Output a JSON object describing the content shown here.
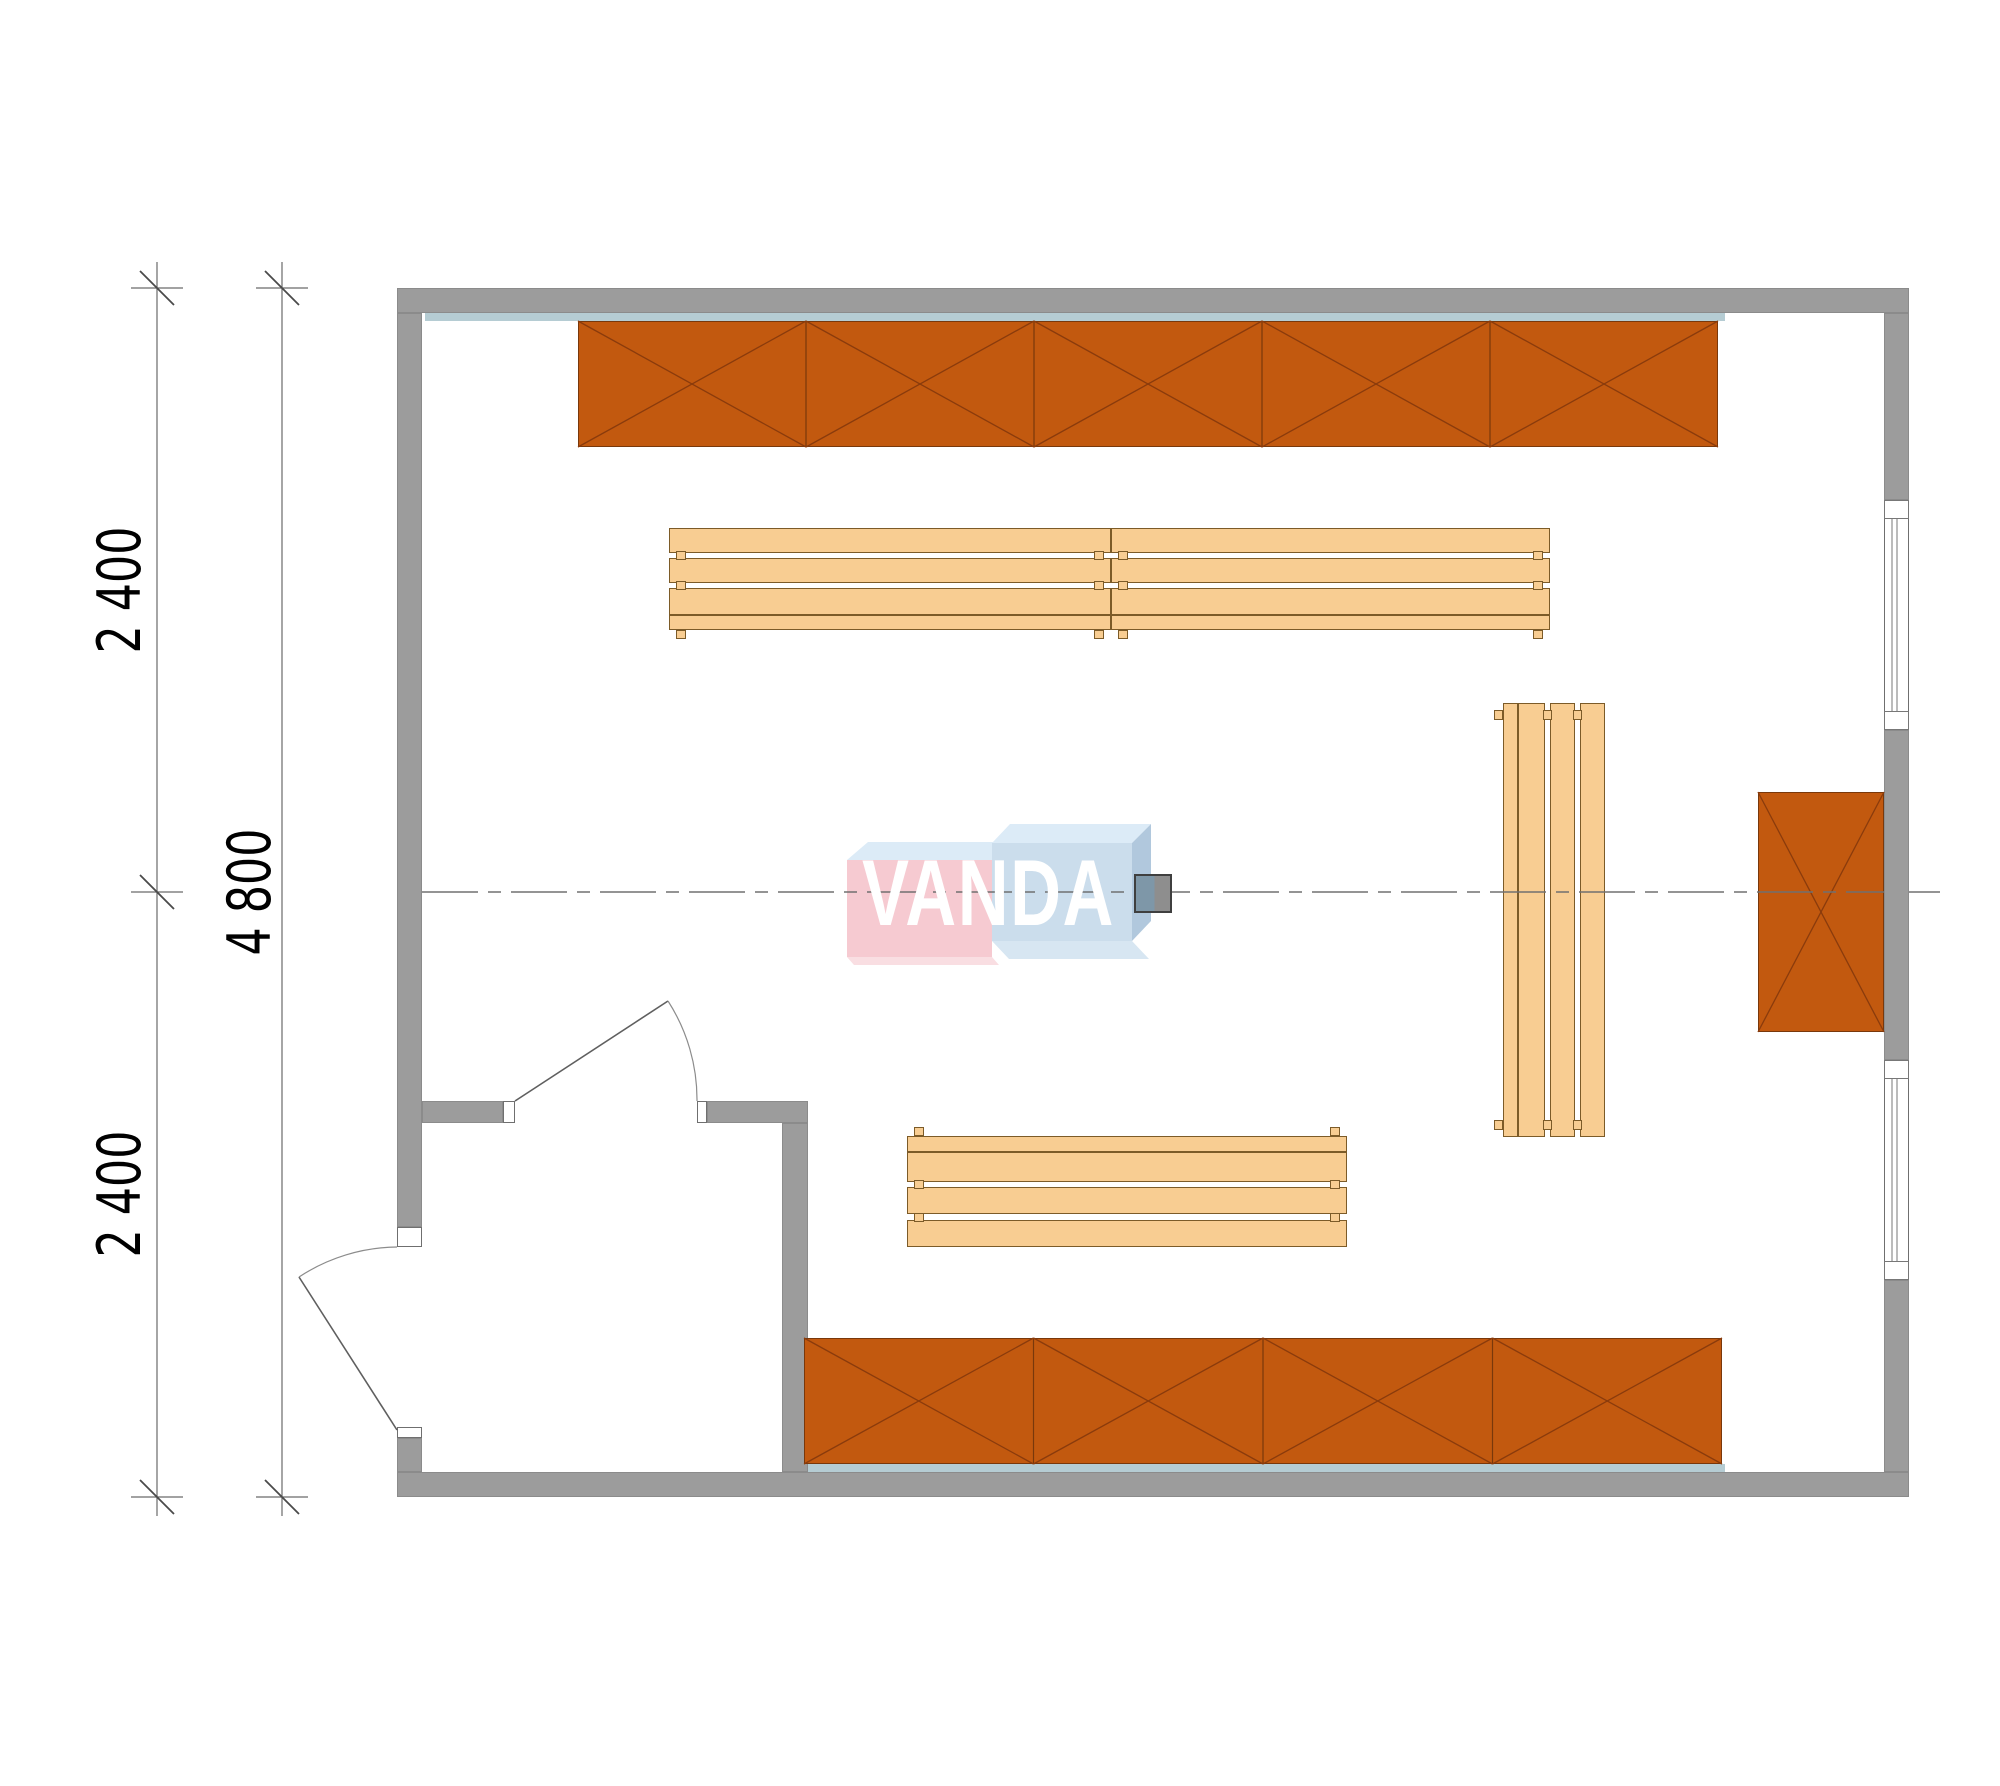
{
  "canvas": {
    "width": 2000,
    "height": 1786
  },
  "colors": {
    "background": "#ffffff",
    "wall": "#9c9c9c",
    "wall_edge": "#8b8b8b",
    "lining": "#b5ccd3",
    "shelf_fill": "#c2590f",
    "shelf_line": "#79380b",
    "shelf_diagonal": "#8a3b0c",
    "bench_fill": "#f8cd92",
    "bench_line": "#7c5b28",
    "drawing_line": "#6a6a6a",
    "tick_line": "#4a4a4a",
    "door_arc": "#8c8c8c",
    "centerline": "#707070",
    "glass_line": "#777777",
    "heater_left": "#7e97a8",
    "heater_right": "#8e8e8e",
    "text": "#000000"
  },
  "dimensions": {
    "lines": [
      {
        "name": "dim-line-inner",
        "x": 157,
        "y1": 262,
        "y2": 1516,
        "ticks": [
          288,
          892,
          1497
        ]
      },
      {
        "name": "dim-line-outer",
        "x": 282,
        "y1": 262,
        "y2": 1516,
        "ticks": [
          288,
          1497
        ]
      }
    ],
    "tick": {
      "arm": 26,
      "slash": 17
    },
    "labels": [
      {
        "text": "2 400",
        "x": 120,
        "y": 590,
        "font_size": 60
      },
      {
        "text": "4 800",
        "x": 250,
        "y": 892,
        "font_size": 60
      },
      {
        "text": "2 400",
        "x": 120,
        "y": 1194,
        "font_size": 60
      }
    ]
  },
  "centerline": {
    "y": 892,
    "segments": [
      [
        422,
        1884
      ],
      [
        1909,
        1940
      ]
    ],
    "dash": "56 10 13 10"
  },
  "walls": [
    {
      "name": "wall-top",
      "x": 397,
      "y": 288,
      "w": 1512,
      "h": 25
    },
    {
      "name": "wall-bottom",
      "x": 397,
      "y": 1472,
      "w": 1512,
      "h": 25
    },
    {
      "name": "wall-left-upper",
      "x": 397,
      "y": 313,
      "w": 25,
      "h": 914
    },
    {
      "name": "wall-left-door-stub",
      "x": 397,
      "y": 1438,
      "w": 25,
      "h": 34
    },
    {
      "name": "wall-right-upper",
      "x": 1884,
      "y": 313,
      "w": 25,
      "h": 187
    },
    {
      "name": "wall-right-middle",
      "x": 1884,
      "y": 730,
      "w": 25,
      "h": 330
    },
    {
      "name": "wall-right-lower",
      "x": 1884,
      "y": 1280,
      "w": 25,
      "h": 192
    },
    {
      "name": "partition-horizontal-left",
      "x": 422,
      "y": 1101,
      "w": 81,
      "h": 22
    },
    {
      "name": "partition-horizontal-right",
      "x": 707,
      "y": 1101,
      "w": 101,
      "h": 22
    },
    {
      "name": "partition-vertical",
      "x": 782,
      "y": 1123,
      "w": 26,
      "h": 349
    }
  ],
  "jambs": [
    {
      "name": "jamb-exterior-door-top",
      "x": 397,
      "y": 1227,
      "w": 25,
      "h": 20
    },
    {
      "name": "jamb-exterior-door-bottom",
      "x": 397,
      "y": 1427,
      "w": 25,
      "h": 11
    },
    {
      "name": "jamb-interior-door-left",
      "x": 503,
      "y": 1101,
      "w": 12,
      "h": 22
    },
    {
      "name": "jamb-interior-door-right",
      "x": 697,
      "y": 1101,
      "w": 10,
      "h": 22
    }
  ],
  "windows": [
    {
      "name": "window-upper",
      "x": 1884,
      "y": 500,
      "w": 25,
      "h": 230,
      "cap": 19
    },
    {
      "name": "window-lower",
      "x": 1884,
      "y": 1060,
      "w": 25,
      "h": 220,
      "cap": 19
    }
  ],
  "linings": [
    {
      "name": "lining-top-wall",
      "x": 425,
      "y": 313,
      "w": 1300,
      "h": 8
    },
    {
      "name": "lining-bottom-wall",
      "x": 808,
      "y": 1464,
      "w": 917,
      "h": 8
    },
    {
      "name": "lining-right-wall",
      "x": 1876,
      "y": 792,
      "w": 8,
      "h": 240
    },
    {
      "name": "lining-partition",
      "x": 808,
      "y": 1338,
      "w": 8,
      "h": 126
    }
  ],
  "shelf_units": [
    {
      "name": "shelf-bank-top",
      "x": 578,
      "y": 321,
      "w": 1140,
      "h": 126,
      "segments": 5
    },
    {
      "name": "shelf-bank-bottom",
      "x": 804,
      "y": 1338,
      "w": 918,
      "h": 126,
      "segments": 4
    },
    {
      "name": "shelf-box-right",
      "x": 1758,
      "y": 792,
      "w": 126,
      "h": 240,
      "segments": 1
    }
  ],
  "benches": [
    {
      "name": "bench-upper-left",
      "orient": "h",
      "edge_at": "end",
      "x": 669,
      "y": 528,
      "length": 442,
      "depth": 102
    },
    {
      "name": "bench-upper-right",
      "orient": "h",
      "edge_at": "end",
      "x": 1111,
      "y": 528,
      "length": 439,
      "depth": 102
    },
    {
      "name": "bench-lower",
      "orient": "h",
      "edge_at": "start",
      "x": 907,
      "y": 1136,
      "length": 440,
      "depth": 111
    },
    {
      "name": "bench-right-vertical",
      "orient": "v",
      "edge_at": "start",
      "x": 1503,
      "y": 703,
      "length": 434,
      "depth": 102
    }
  ],
  "bench_profile": {
    "bands": [
      0.147,
      0.265,
      0.049,
      0.245,
      0.049,
      0.245
    ],
    "band_types": [
      "thin",
      "thick",
      "gap",
      "slat",
      "gap",
      "slat"
    ],
    "foot_size": 10,
    "foot_out": 9,
    "foot_inset": 7
  },
  "doors": {
    "exterior": {
      "leaf": "M397,1430 L299,1277",
      "arc": "M299,1277 A182,182 0 0 1 397,1247"
    },
    "interior": {
      "leaf": "M515,1101 L668,1001",
      "arc": "M668,1001 A182,182 0 0 1 697,1101"
    }
  },
  "heater": {
    "x": 1134,
    "y": 874,
    "w": 38,
    "h": 39
  },
  "watermark": {
    "text": "VANDA",
    "text_x": 862,
    "text_y": 846,
    "font_size": 94,
    "blocks": [
      {
        "name": "logo-left-top-face",
        "points": "847,860 868,842 1014,842 992,860",
        "fill": "#dcebf7"
      },
      {
        "name": "logo-left-front-face",
        "points": "847,860 992,860 992,957 847,957",
        "fill": "#f6cad1"
      },
      {
        "name": "logo-left-bottom-face",
        "points": "847,957 992,957 999,965 854,965",
        "fill": "#f9dee2"
      },
      {
        "name": "logo-right-top-face",
        "points": "992,843 1010,824 1151,824 1132,843",
        "fill": "#dcebf7"
      },
      {
        "name": "logo-right-front-face",
        "points": "992,843 1132,843 1132,941 992,941",
        "fill": "#cbddec"
      },
      {
        "name": "logo-right-side-face",
        "points": "1132,843 1151,824 1151,921 1132,941",
        "fill": "#b1c8dd"
      },
      {
        "name": "logo-right-bottom-face",
        "points": "992,941 1132,941 1149,959 1009,959",
        "fill": "#d7e6f2"
      }
    ]
  }
}
